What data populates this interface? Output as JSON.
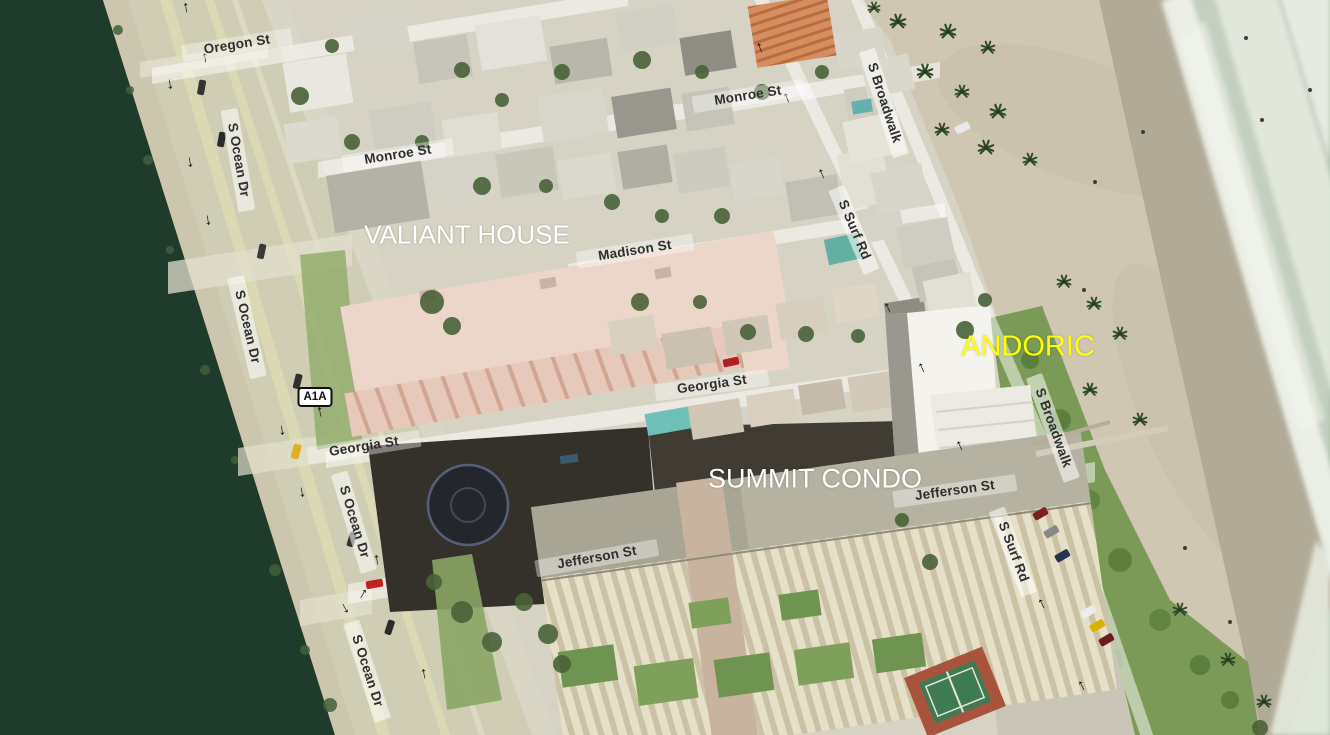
{
  "map": {
    "view": "oblique-aerial-imagery",
    "place_labels": [
      {
        "id": "valiant-house",
        "text": "VALIANT HOUSE",
        "color": "#ffffff"
      },
      {
        "id": "andoric",
        "text": "ANDORIC",
        "color": "#ffff00"
      },
      {
        "id": "summit-condo",
        "text": "SUMMIT CONDO",
        "color": "#ffffff"
      }
    ],
    "street_labels": [
      {
        "text": "Oregon St"
      },
      {
        "text": "Monroe St"
      },
      {
        "text": "Monroe St"
      },
      {
        "text": "Madison St"
      },
      {
        "text": "Georgia St"
      },
      {
        "text": "Georgia St"
      },
      {
        "text": "Jefferson St"
      },
      {
        "text": "Jefferson St"
      },
      {
        "text": "S Ocean Dr"
      },
      {
        "text": "S Ocean Dr"
      },
      {
        "text": "S Ocean Dr"
      },
      {
        "text": "S Ocean Dr"
      },
      {
        "text": "S Broadwalk"
      },
      {
        "text": "S Broadwalk"
      },
      {
        "text": "S Surf Rd"
      },
      {
        "text": "S Surf Rd"
      }
    ],
    "route_shield": {
      "text": "A1A",
      "background": "#ffffff",
      "border": "#000000"
    },
    "icons": {
      "one_way_arrow": "↑"
    },
    "colors": {
      "intracoastal_water": "#1e3b2c",
      "ocean": "#a9bca6",
      "surf_foam": "#edf0e8",
      "beach_sand": "#cfc7b2",
      "wet_sand": "#b1aa97",
      "dune_vegetation": "#7b9a57",
      "road": "#cfcdb4",
      "street_ribbon": "rgba(255,255,255,0.5)",
      "street_label_text": "#2e2e2e"
    }
  }
}
